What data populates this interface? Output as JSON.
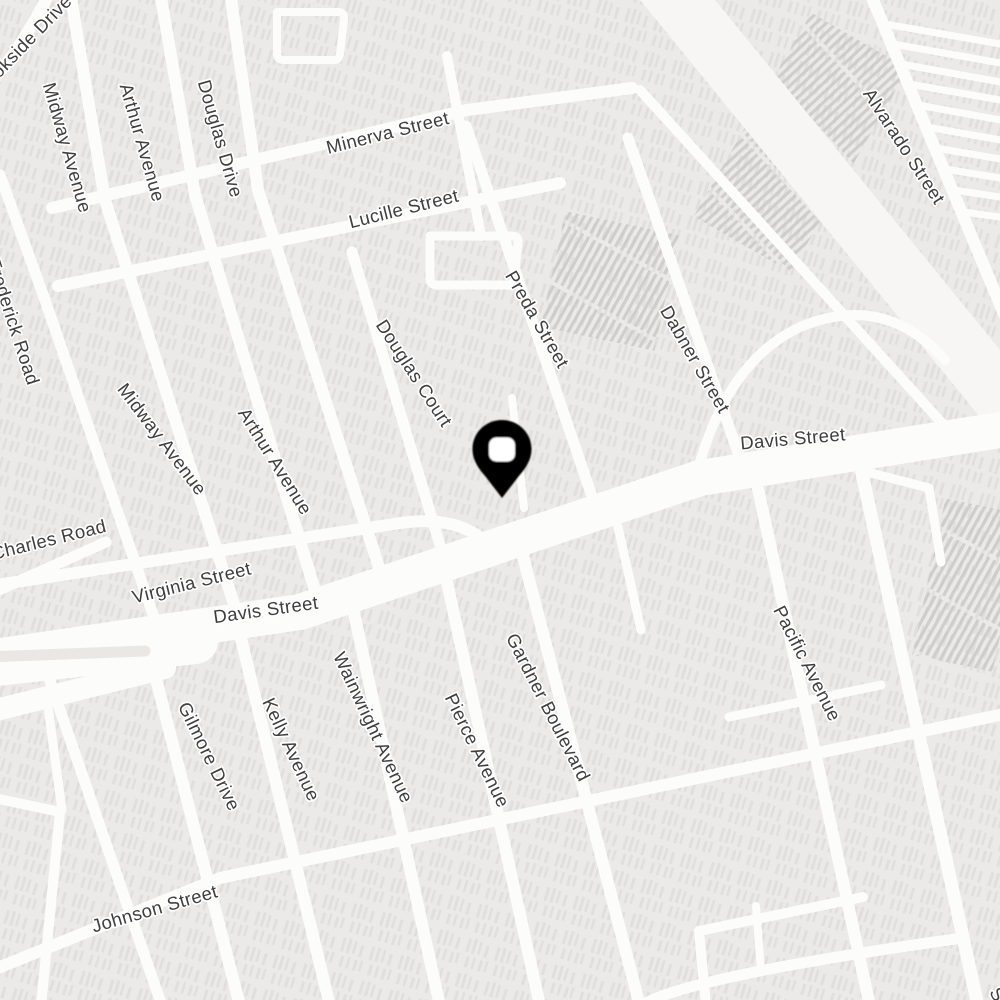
{
  "map": {
    "background_color": "#ECEAE8",
    "road_color": "#FCFCFB",
    "corridor_color": "#F7F6F4",
    "median_color": "#E9E8E5",
    "building_hatch_color": "#D6D5D2",
    "dense_hatch_color": "#C8C7C4",
    "label_color": "#3E3E3E",
    "label_halo_color": "#FFFFFF",
    "label_font_size": 18.5,
    "pin": {
      "name": "dropped-pin",
      "cx": 502,
      "cy": 449,
      "tip_y": 498,
      "body_color": "#000000",
      "hole_color": "#FFFFFF"
    },
    "street_labels": [
      {
        "text": "Brookside Drive",
        "x": 22,
        "y": 48,
        "rotation": -46,
        "partial": true
      },
      {
        "text": "Midway Avenue",
        "x": 66,
        "y": 148,
        "rotation": 74
      },
      {
        "text": "Arthur Avenue",
        "x": 141,
        "y": 143,
        "rotation": 74
      },
      {
        "text": "Douglas Drive",
        "x": 219,
        "y": 139,
        "rotation": 74
      },
      {
        "text": "Minerva Street",
        "x": 388,
        "y": 134,
        "rotation": -14
      },
      {
        "text": "Lucille Street",
        "x": 404,
        "y": 210,
        "rotation": -14
      },
      {
        "text": "Preda Street",
        "x": 536,
        "y": 320,
        "rotation": 60
      },
      {
        "text": "Dabner Street",
        "x": 694,
        "y": 360,
        "rotation": 60
      },
      {
        "text": "Alvarado Street",
        "x": 903,
        "y": 147,
        "rotation": 57
      },
      {
        "text": "Frederick Road",
        "x": 12,
        "y": 322,
        "rotation": 72,
        "partial": true
      },
      {
        "text": "Midway Avenue",
        "x": 161,
        "y": 440,
        "rotation": 53
      },
      {
        "text": "Arthur Avenue",
        "x": 274,
        "y": 462,
        "rotation": 58
      },
      {
        "text": "Douglas Court",
        "x": 413,
        "y": 374,
        "rotation": 57
      },
      {
        "text": "Davis Street",
        "x": 793,
        "y": 440,
        "rotation": -5
      },
      {
        "text": "Charles Road",
        "x": 49,
        "y": 541,
        "rotation": -14
      },
      {
        "text": "Virginia Street",
        "x": 192,
        "y": 584,
        "rotation": -14
      },
      {
        "text": "Davis Street",
        "x": 266,
        "y": 611,
        "rotation": -8
      },
      {
        "text": "Pacific Avenue",
        "x": 806,
        "y": 664,
        "rotation": 63
      },
      {
        "text": "Gilmore Drive",
        "x": 208,
        "y": 757,
        "rotation": 64
      },
      {
        "text": "Kelly Avenue",
        "x": 290,
        "y": 750,
        "rotation": 65
      },
      {
        "text": "Wainwright Avenue",
        "x": 372,
        "y": 728,
        "rotation": 65
      },
      {
        "text": "Pierce Avenue",
        "x": 476,
        "y": 751,
        "rotation": 64
      },
      {
        "text": "Gardner Boulevard",
        "x": 547,
        "y": 708,
        "rotation": 63
      },
      {
        "text": "Johnson Street",
        "x": 155,
        "y": 910,
        "rotation": -16
      },
      {
        "text": "Street",
        "x": 1006,
        "y": 1012,
        "rotation": 60,
        "partial": true
      }
    ],
    "roads": [
      {
        "name": "railroad-corridor",
        "d": "M645,-40 L1010,408",
        "width": 58,
        "color": "#F7F6F4"
      },
      {
        "name": "trailer-park-lanes",
        "d": "M885,24 L1006,45 M893,44 L1006,64 M901,64 L1006,83 M909,84 L1006,101 M918,105 L1006,121 M927,127 L1006,141 M936,148 L1006,160 M945,169 L1006,179 M954,190 L1006,198 M964,212 L1006,218",
        "width": 7
      },
      {
        "name": "brookside-drive",
        "d": "M-14,88 Q20,52 52,-12",
        "width": 12
      },
      {
        "name": "north-loop",
        "d": "M277,12 L338,12 Q345,12 344,20 L340,54 Q339,61 332,60 L284,60 Q277,60 277,53 Z",
        "width": 8
      },
      {
        "name": "frederick-road",
        "d": "M0,175 L45,300 L160,635",
        "width": 11
      },
      {
        "name": "midway-avenue",
        "d": "M70,-8 L105,200 L240,623",
        "width": 12
      },
      {
        "name": "arthur-avenue",
        "d": "M160,-8 L195,195 L320,607",
        "width": 12
      },
      {
        "name": "douglas-drive",
        "d": "M230,-8 L258,190 L385,586",
        "width": 12
      },
      {
        "name": "mini-vertical",
        "d": "M447,56 L481,236",
        "width": 10
      },
      {
        "name": "mini-loop",
        "d": "M430,236 L512,236 Q519,236 518,243 L514,279 Q513,286 506,285 L437,285 Q430,285 430,278 Z",
        "width": 9
      },
      {
        "name": "douglas-court",
        "d": "M352,252 L446,565",
        "width": 11
      },
      {
        "name": "preda-street",
        "d": "M466,126 L598,514",
        "width": 11
      },
      {
        "name": "dabner-street",
        "d": "M628,138 L748,481",
        "width": 11
      },
      {
        "name": "dabner-hook",
        "d": "M700,462 Q730,360 800,327 Q885,292 945,360",
        "width": 10
      },
      {
        "name": "minerva-street",
        "d": "M52,208 L467,110 L632,88",
        "width": 12
      },
      {
        "name": "corridor-side-road",
        "d": "M640,90 L950,432",
        "width": 10
      },
      {
        "name": "lucille-street",
        "d": "M58,286 L560,183",
        "width": 12
      },
      {
        "name": "virginia-street",
        "d": "M-10,586 L400,523 Q450,516 478,536",
        "width": 12
      },
      {
        "name": "charles-road",
        "d": "M-12,595 L106,542",
        "width": 11
      },
      {
        "name": "alvarado-street",
        "d": "M868,-12 L1004,314",
        "width": 12
      },
      {
        "name": "pin-block-stub",
        "d": "M512,398 L524,508",
        "width": 8
      },
      {
        "name": "gardner-east-stub",
        "d": "M614,509 L641,630",
        "width": 9
      },
      {
        "name": "johnson-street",
        "d": "M-12,972 L220,878 L1004,714",
        "width": 12
      },
      {
        "name": "bottom-cross-road",
        "d": "M648,1002 Q700,975 962,938",
        "width": 11
      },
      {
        "name": "pacific-avenue",
        "d": "M752,461 L870,1006",
        "width": 12
      },
      {
        "name": "se-diagonal-street",
        "d": "M858,455 L978,1006",
        "width": 13
      },
      {
        "name": "gilmore-drive",
        "d": "M145,636 L240,1006",
        "width": 12
      },
      {
        "name": "kelly-avenue",
        "d": "M237,622 L330,1006",
        "width": 12
      },
      {
        "name": "wainwright-avenue",
        "d": "M350,595 L440,1006",
        "width": 12
      },
      {
        "name": "pierce-avenue",
        "d": "M443,564 L540,1006",
        "width": 12
      },
      {
        "name": "gardner-boulevard",
        "d": "M519,541 L640,1006",
        "width": 12
      },
      {
        "name": "west-vertical-street",
        "d": "M40,652 L162,1006",
        "width": 11
      },
      {
        "name": "left-loop",
        "d": "M-6,798 L60,812 L41,1006",
        "width": 10
      },
      {
        "name": "left-vertical-connector",
        "d": "M46,692 L62,810",
        "width": 9
      },
      {
        "name": "pacific-cross-stub",
        "d": "M729,717 L881,685",
        "width": 9
      },
      {
        "name": "se-l-road",
        "d": "M706,1006 L699,931 L863,897",
        "width": 10
      },
      {
        "name": "se-stub",
        "d": "M761,971 L756,906",
        "width": 8
      },
      {
        "name": "se-upper-l-road",
        "d": "M871,473 L929,488 L941,562",
        "width": 9
      },
      {
        "name": "davis-street-west-wide",
        "d": "M-12,664 L195,641",
        "width": 46
      },
      {
        "name": "davis-street",
        "d": "M-12,658 L300,612 L700,478 L1012,428",
        "width": 36
      },
      {
        "name": "davis-street-south-lanes",
        "d": "M-12,712 L165,668",
        "width": 22
      },
      {
        "name": "davis-median-island",
        "d": "M-14,657 L145,651",
        "width": 11,
        "color": "#E9E8E5"
      }
    ],
    "hatch_areas": [
      {
        "name": "rail-yard-hatch",
        "x": 552,
        "y": 222,
        "w": 116,
        "h": 118,
        "rotation": 12
      },
      {
        "name": "se-yard-hatch",
        "x": 928,
        "y": 505,
        "w": 82,
        "h": 160,
        "rotation": 12
      },
      {
        "name": "ne-trailer-hatch",
        "x": 745,
        "y": 25,
        "w": 112,
        "h": 235,
        "rotation": 30
      }
    ]
  }
}
